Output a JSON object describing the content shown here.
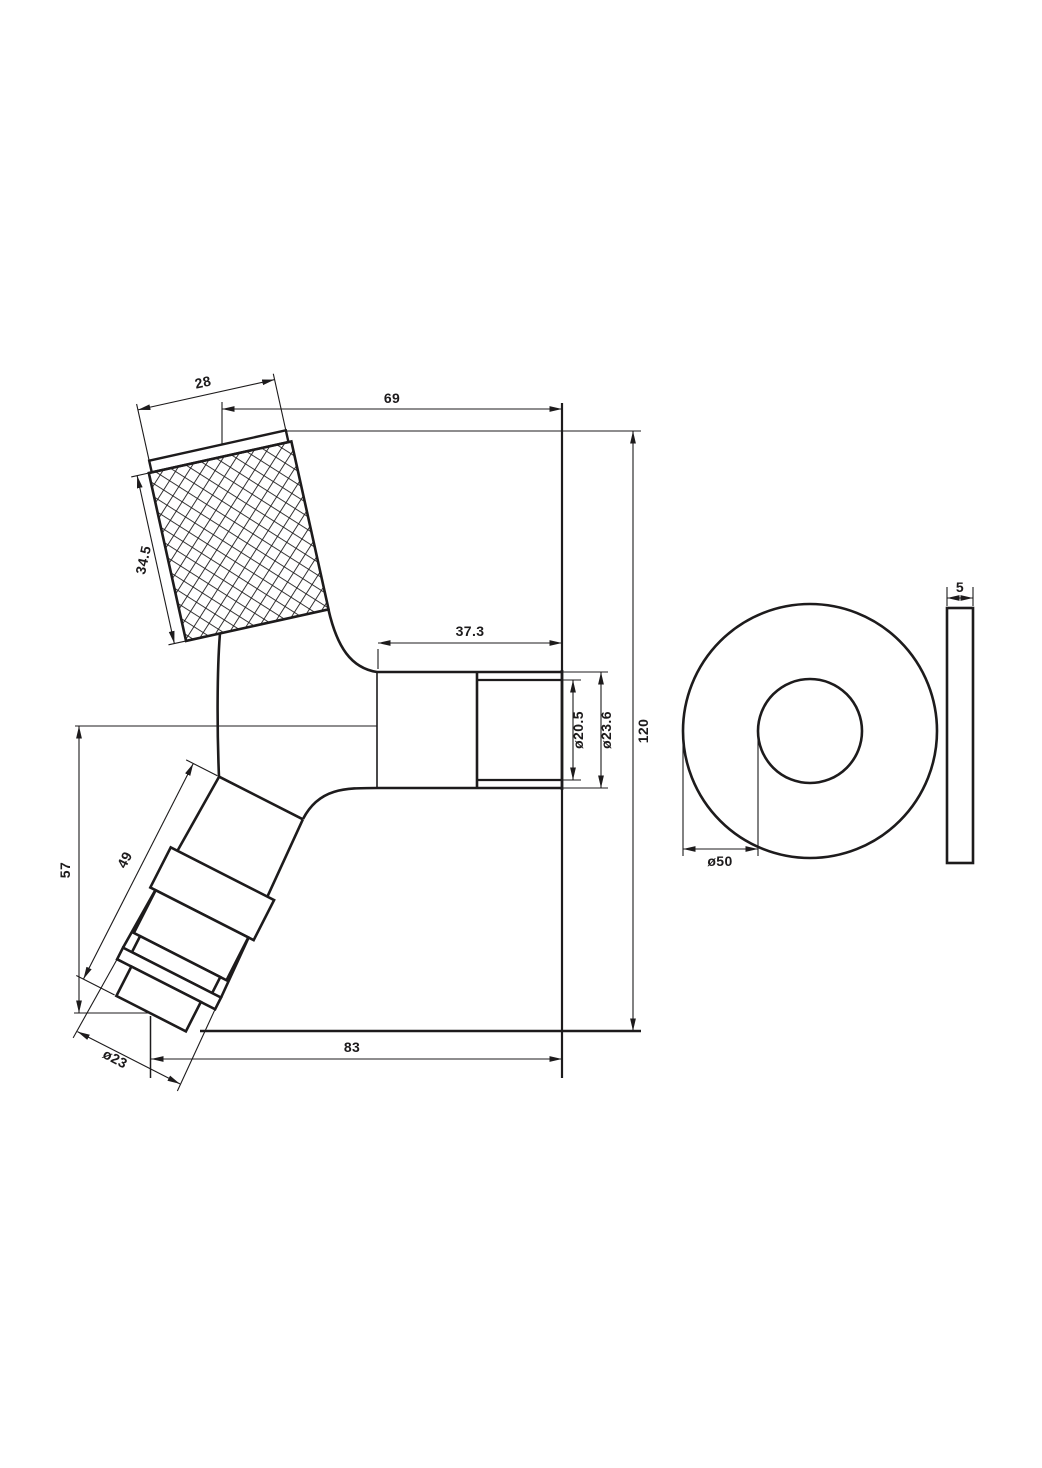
{
  "drawing": {
    "title": "bibcock-tap-technical-drawing",
    "colors": {
      "line": "#1d1b1c",
      "background": "#ffffff"
    },
    "views": {
      "front_view": "tap-front-view",
      "washer_front": "washer-front-view",
      "washer_side": "washer-side-view"
    },
    "dimensions": {
      "knob_top_width": "28",
      "knob_side_length": "34.5",
      "handle_axis_to_spout_end": "69",
      "spout_thread_length": "37.3",
      "spout_thread_diameter": "ø20.5",
      "spout_outer_diameter": "ø23.6",
      "overall_height": "120",
      "spout_axis_to_inlet_tip": "57",
      "inlet_leg_length": "49",
      "inlet_tip_diameter": "ø23",
      "inlet_tip_to_spout_end": "83",
      "washer_outer_diameter": "ø50",
      "washer_thickness": "5"
    }
  }
}
